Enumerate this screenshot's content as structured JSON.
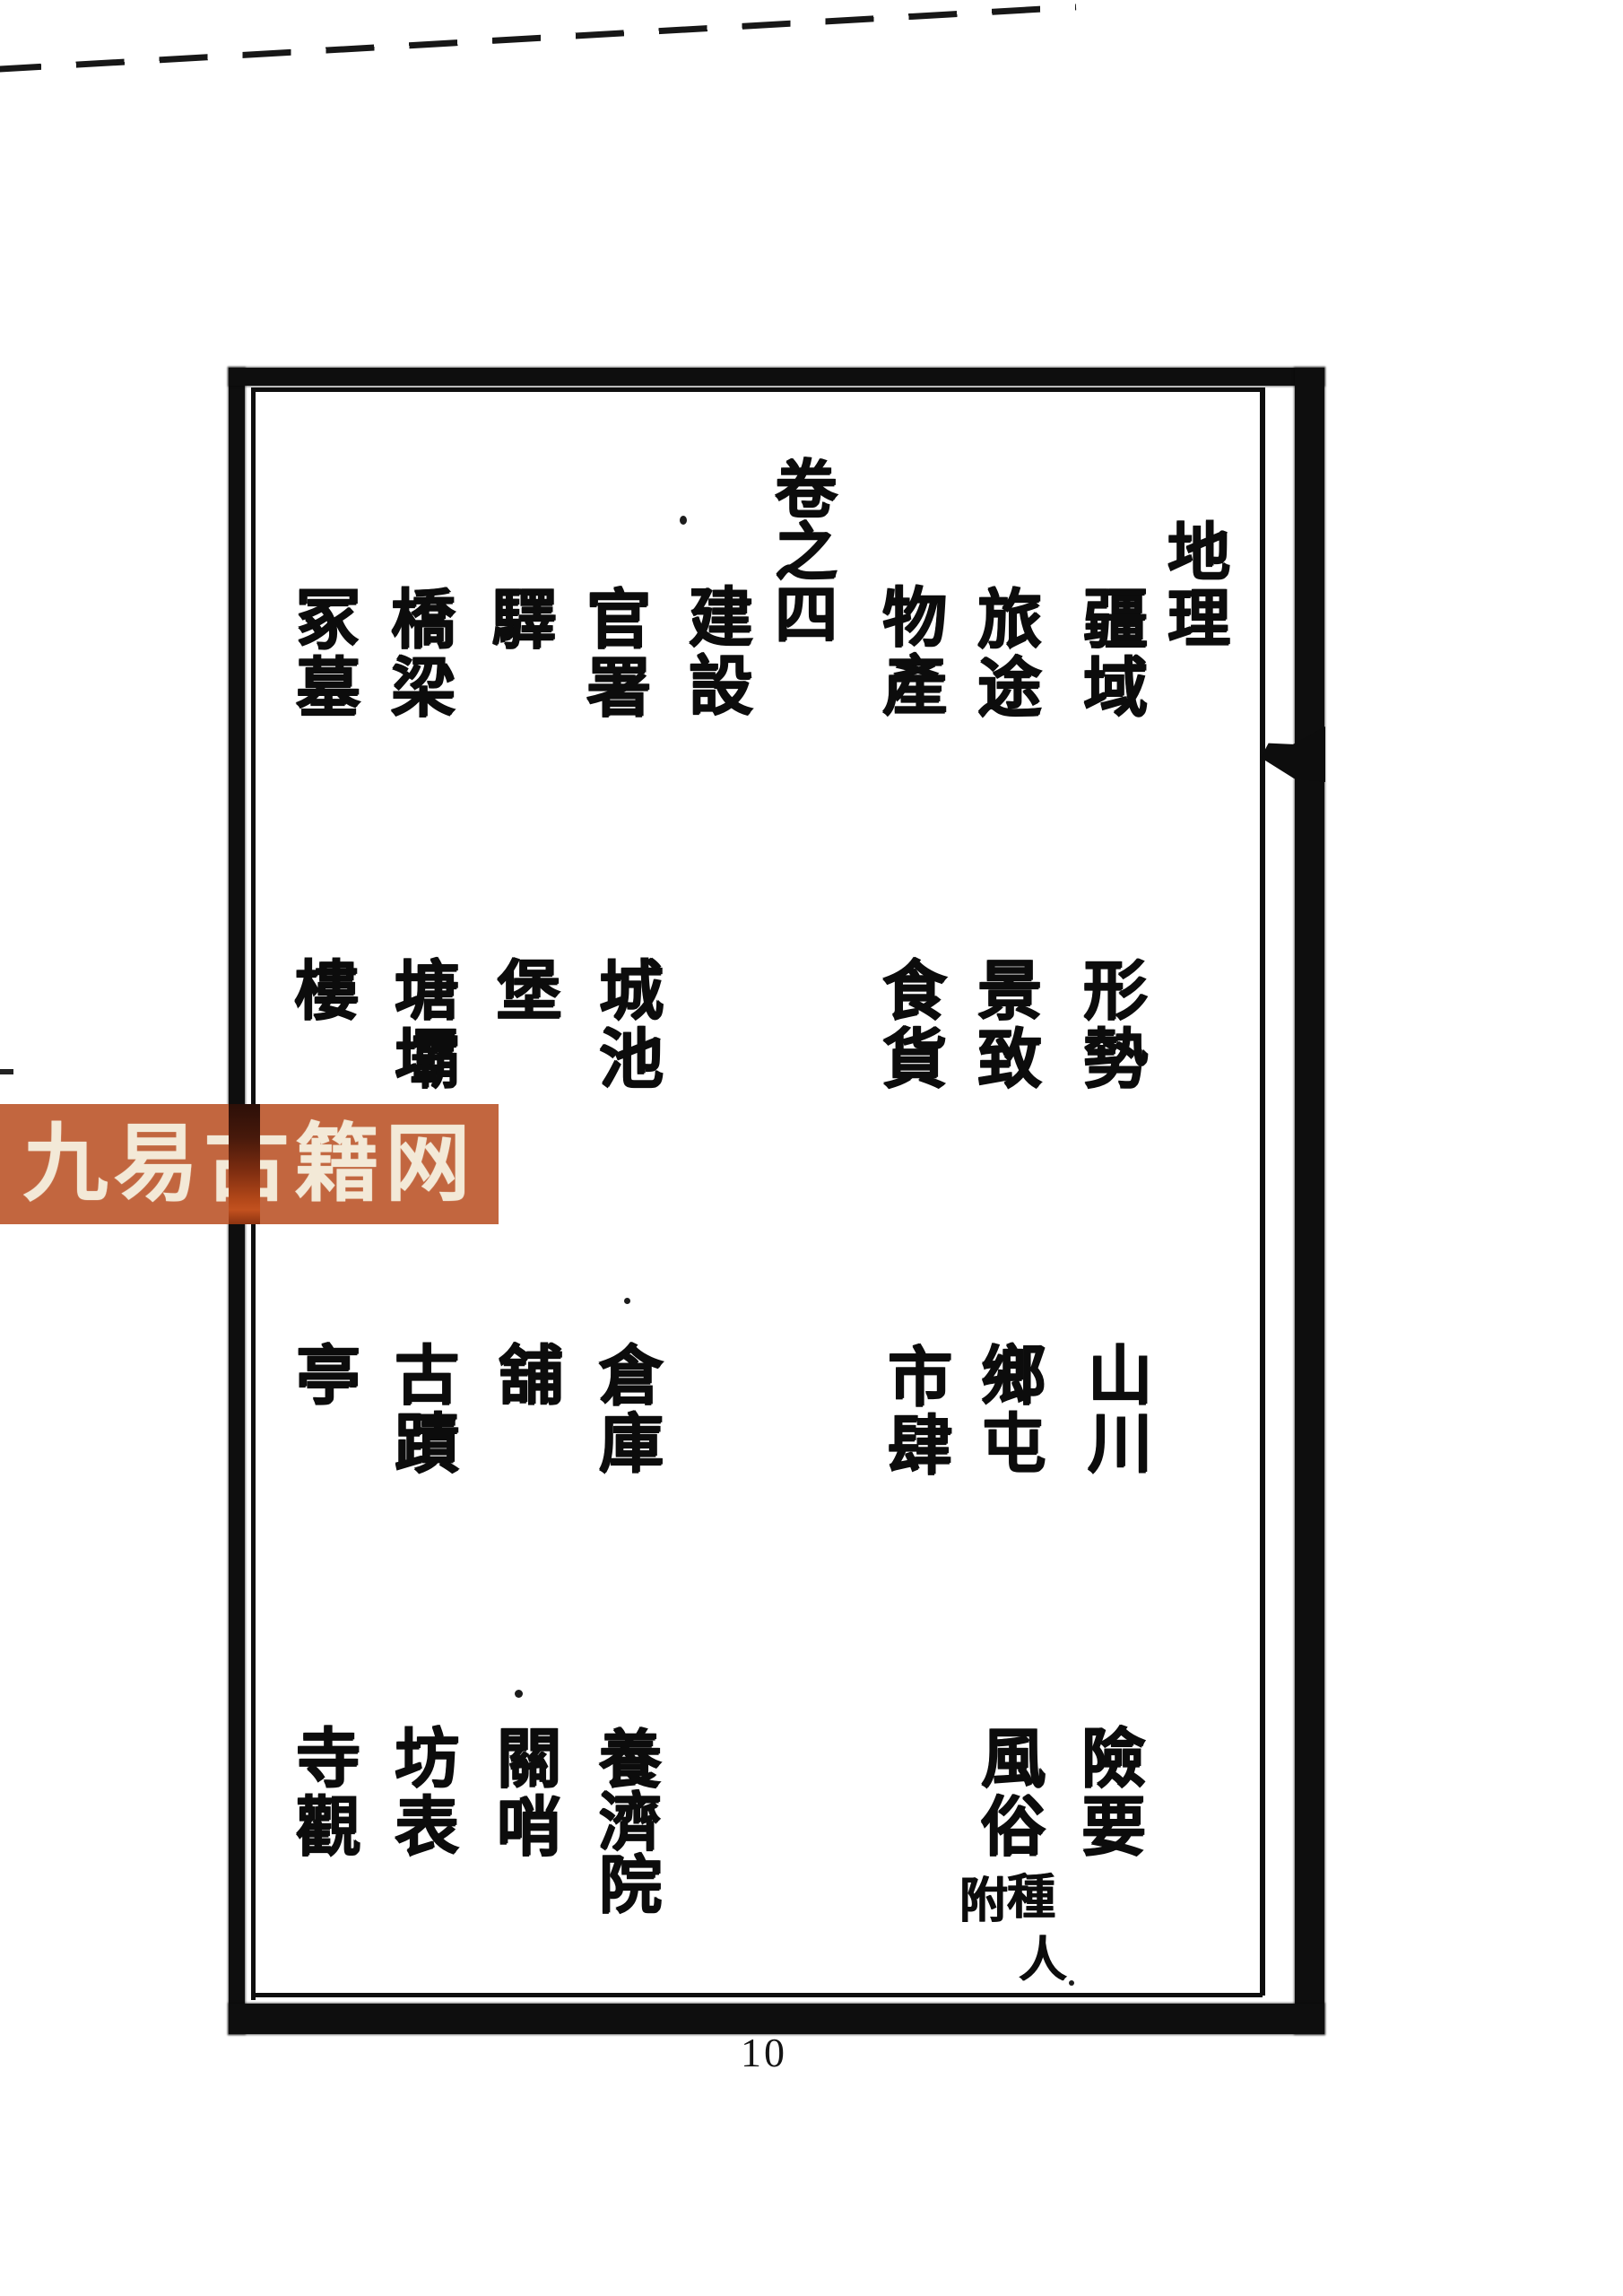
{
  "header": {
    "volume_label": "卷之四",
    "section_title": "地理"
  },
  "contents": {
    "col_geo_1": {
      "r1": "疆域",
      "r2": "形勢",
      "r3": "山川",
      "r4": "險要"
    },
    "col_geo_2": {
      "r1": "旅途",
      "r2": "景致",
      "r3": "鄉屯",
      "r4": "風俗",
      "r4_note_1": "附",
      "r4_note_2": "種",
      "r4_note_3": "人"
    },
    "col_geo_3": {
      "r1": "物產",
      "r2": "食貨",
      "r3": "市肆"
    },
    "construction_header": "建設",
    "col_js_1": {
      "r1": "官署",
      "r2": "城池",
      "r3": "倉庫",
      "r4": "養濟院"
    },
    "col_js_2": {
      "r1": "驛",
      "r2": "堡",
      "r3": "舖",
      "r4": "關哨"
    },
    "col_js_3": {
      "r1": "橋梁",
      "r2": "塘壩",
      "r3": "古蹟",
      "r4": "坊表"
    },
    "col_js_4": {
      "r1": "冢墓",
      "r2": "樓",
      "r3": "亭",
      "r4": "寺觀"
    }
  },
  "watermark": {
    "text": "九易古籍网",
    "bg_color": "#c2663f",
    "text_color": "#f3e9d7"
  },
  "footer": {
    "page_number": "10"
  }
}
